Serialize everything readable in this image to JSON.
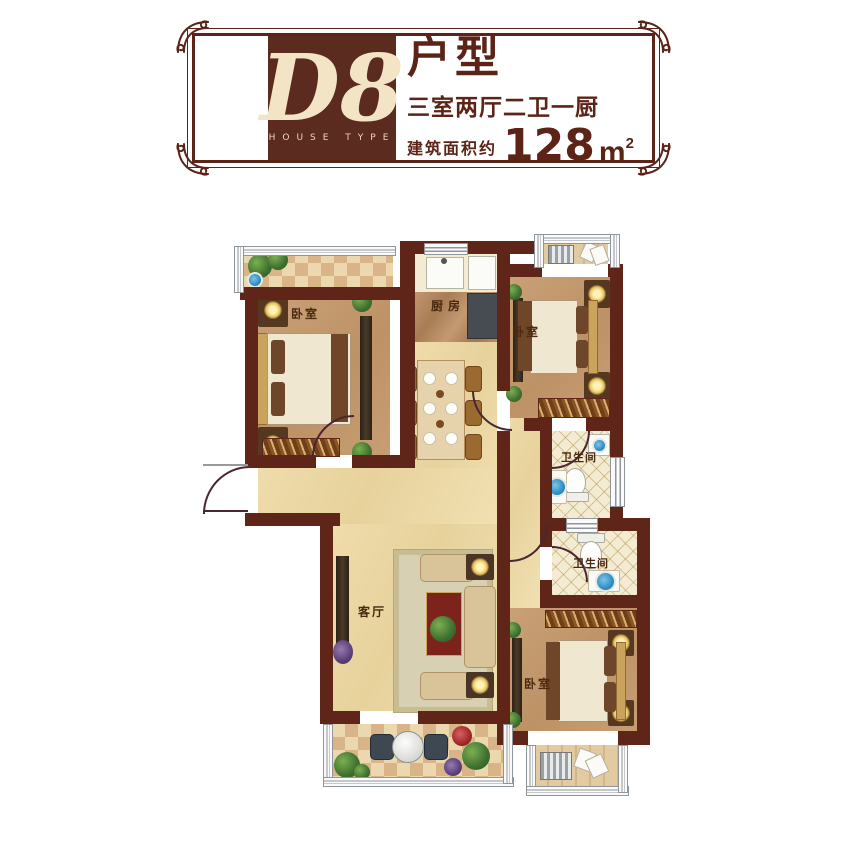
{
  "header": {
    "unit_code": "D8",
    "house_type_en": "HOUSE TYPE",
    "type_label": "户型",
    "layout_desc": "三室两厅二卫一厨",
    "area_prefix": "建筑面积约",
    "area_number": "128",
    "area_unit": "m",
    "area_exponent": "2"
  },
  "floorplan": {
    "rooms": {
      "bedroom_top_left": {
        "label": "卧室"
      },
      "bedroom_top_right": {
        "label": "卧室"
      },
      "bedroom_bottom_right": {
        "label": "卧室"
      },
      "kitchen": {
        "label": "厨房"
      },
      "living_room": {
        "label": "客厅"
      },
      "bathroom_upper": {
        "label": "卫生间"
      },
      "bathroom_lower": {
        "label": "卫生间"
      }
    }
  },
  "colors": {
    "wall": "#5e2518",
    "header_brown": "#5c2b1f",
    "floor_light": "#ecd9a8",
    "floor_bedroom": "#c79e74",
    "floor_marble": "#b78c63",
    "floor_bath": "#f4ecd2",
    "text_dark": "#4a2c15"
  }
}
